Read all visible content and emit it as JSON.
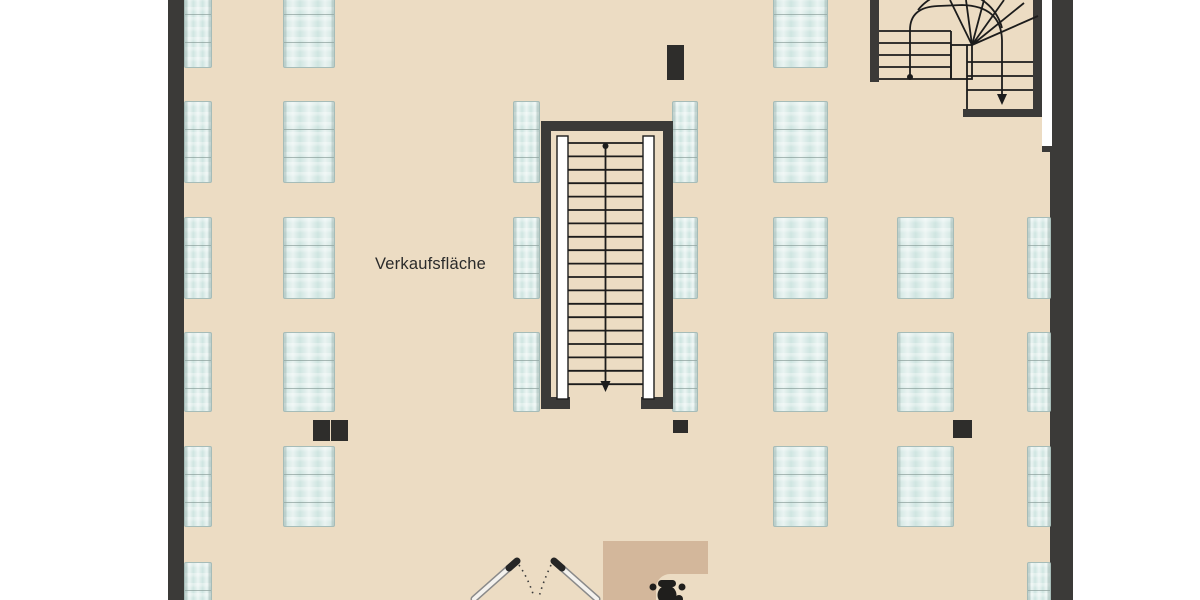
{
  "labels": {
    "sales_area": "Verkaufsfläche"
  },
  "colors": {
    "floor": "#ecdcc3",
    "wall": "#3b3a38",
    "shelf": "#cfe5e1",
    "shelf_border": "#a6bcb8",
    "counter": "#d3b79b",
    "ink": "#1c1c1c",
    "pillar": "#2e2d2b"
  },
  "walls": [
    {
      "name": "left-wall",
      "x": 168,
      "y": 0,
      "w": 16,
      "h": 600
    },
    {
      "name": "right-wall",
      "x": 1050,
      "y": 0,
      "w": 23,
      "h": 600
    }
  ],
  "shelves": [
    {
      "x": 184,
      "y": -14,
      "w": 28,
      "h": 82
    },
    {
      "x": 283,
      "y": -14,
      "w": 52,
      "h": 82
    },
    {
      "x": 773,
      "y": -14,
      "w": 55,
      "h": 82
    },
    {
      "x": 184,
      "y": 101,
      "w": 28,
      "h": 82
    },
    {
      "x": 283,
      "y": 101,
      "w": 52,
      "h": 82
    },
    {
      "x": 513,
      "y": 101,
      "w": 27,
      "h": 82
    },
    {
      "x": 672,
      "y": 101,
      "w": 26,
      "h": 82
    },
    {
      "x": 773,
      "y": 101,
      "w": 55,
      "h": 82
    },
    {
      "x": 184,
      "y": 217,
      "w": 28,
      "h": 82
    },
    {
      "x": 283,
      "y": 217,
      "w": 52,
      "h": 82
    },
    {
      "x": 513,
      "y": 217,
      "w": 27,
      "h": 82
    },
    {
      "x": 672,
      "y": 217,
      "w": 26,
      "h": 82
    },
    {
      "x": 773,
      "y": 217,
      "w": 55,
      "h": 82
    },
    {
      "x": 897,
      "y": 217,
      "w": 57,
      "h": 82
    },
    {
      "x": 1027,
      "y": 217,
      "w": 24,
      "h": 82
    },
    {
      "x": 184,
      "y": 332,
      "w": 28,
      "h": 80
    },
    {
      "x": 283,
      "y": 332,
      "w": 52,
      "h": 80
    },
    {
      "x": 513,
      "y": 332,
      "w": 27,
      "h": 80
    },
    {
      "x": 672,
      "y": 332,
      "w": 26,
      "h": 80
    },
    {
      "x": 773,
      "y": 332,
      "w": 55,
      "h": 80
    },
    {
      "x": 897,
      "y": 332,
      "w": 57,
      "h": 80
    },
    {
      "x": 1027,
      "y": 332,
      "w": 24,
      "h": 80
    },
    {
      "x": 184,
      "y": 446,
      "w": 28,
      "h": 81
    },
    {
      "x": 283,
      "y": 446,
      "w": 52,
      "h": 81
    },
    {
      "x": 773,
      "y": 446,
      "w": 55,
      "h": 81
    },
    {
      "x": 897,
      "y": 446,
      "w": 57,
      "h": 81
    },
    {
      "x": 1027,
      "y": 446,
      "w": 24,
      "h": 81
    },
    {
      "x": 184,
      "y": 562,
      "w": 28,
      "h": 60
    },
    {
      "x": 1027,
      "y": 562,
      "w": 24,
      "h": 60
    }
  ],
  "pillars": [
    {
      "x": 667,
      "y": 45,
      "w": 17,
      "h": 35
    },
    {
      "x": 313,
      "y": 420,
      "w": 17,
      "h": 21
    },
    {
      "x": 331,
      "y": 420,
      "w": 17,
      "h": 21
    },
    {
      "x": 673,
      "y": 420,
      "w": 15,
      "h": 13
    },
    {
      "x": 953,
      "y": 420,
      "w": 19,
      "h": 18
    }
  ],
  "stairs": {
    "central_treads": {
      "treads": 19,
      "x1": 568,
      "x2": 643,
      "y_start": 143,
      "step": 13.4
    },
    "upper_left_run": {
      "treads": 5,
      "x1": 879,
      "x2": 951,
      "y_start": 31,
      "step": 12
    },
    "upper_right_run": {
      "treads": 3,
      "x1": 967,
      "x2": 1033,
      "y_start": 62,
      "step": 14
    }
  }
}
